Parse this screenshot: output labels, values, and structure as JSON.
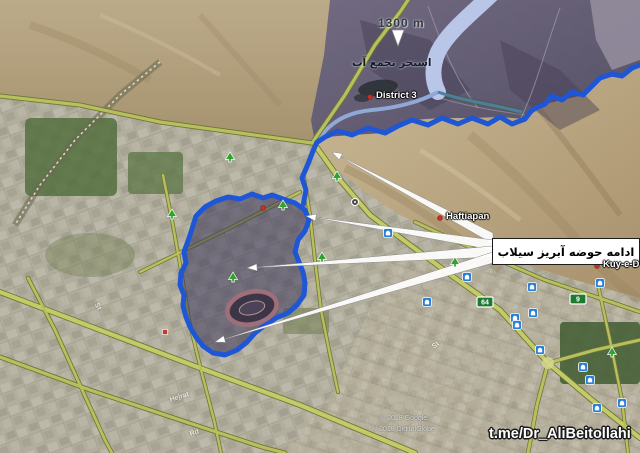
{
  "map": {
    "flood_basin_label": "ادامه حوضه آبریز سیلاب",
    "elevation_label": "1300 m",
    "water_pool_label": "استخر تجمع آب",
    "watermark": "t.me/Dr_AliBeitollahi",
    "copyright_lines": [
      "© 2018 Google",
      "© 2018 DigitalGlobe"
    ],
    "places": [
      {
        "name": "District 3",
        "x": 370,
        "y": 97
      },
      {
        "name": "Haftiapan",
        "x": 440,
        "y": 218
      },
      {
        "name": "Kuy-e-D",
        "x": 597,
        "y": 266
      }
    ],
    "street_labels": [
      {
        "text": "Hejrat",
        "x": 170,
        "y": 397,
        "rot": -18
      },
      {
        "text": "Rd",
        "x": 190,
        "y": 431,
        "rot": -18
      },
      {
        "text": "St",
        "x": 96,
        "y": 300,
        "rot": 62
      },
      {
        "text": "St",
        "x": 433,
        "y": 344,
        "rot": -35
      }
    ],
    "route_shields": [
      {
        "number": "64",
        "x": 485,
        "y": 302
      },
      {
        "number": "9",
        "x": 578,
        "y": 299
      }
    ],
    "tree_icons": [
      [
        230,
        158
      ],
      [
        337,
        177
      ],
      [
        283,
        206
      ],
      [
        172,
        215
      ],
      [
        233,
        278
      ],
      [
        322,
        258
      ],
      [
        455,
        263
      ],
      [
        612,
        353
      ]
    ],
    "mosque_icons": [
      [
        388,
        233
      ],
      [
        467,
        277
      ],
      [
        515,
        318
      ],
      [
        533,
        313
      ],
      [
        517,
        325
      ],
      [
        540,
        350
      ],
      [
        583,
        367
      ],
      [
        590,
        380
      ],
      [
        600,
        283
      ],
      [
        532,
        287
      ],
      [
        622,
        403
      ],
      [
        597,
        408
      ],
      [
        427,
        302
      ]
    ],
    "red_dot_icons": [
      [
        263,
        208
      ]
    ],
    "misc_icons": [
      {
        "type": "roundabout",
        "x": 355,
        "y": 202
      },
      {
        "type": "building",
        "x": 165,
        "y": 332
      }
    ],
    "arrows": [
      {
        "apex": [
          332,
          152
        ],
        "base": [
          [
            493,
            233
          ],
          [
            493,
            244
          ]
        ]
      },
      {
        "apex": [
          306,
          216
        ],
        "base": [
          [
            493,
            240
          ],
          [
            493,
            250
          ]
        ]
      },
      {
        "apex": [
          247,
          268
        ],
        "base": [
          [
            493,
            246
          ],
          [
            493,
            257
          ]
        ]
      },
      {
        "apex": [
          215,
          342
        ],
        "base": [
          [
            493,
            252
          ],
          [
            493,
            263
          ]
        ]
      }
    ],
    "down_arrow": {
      "x": 398,
      "y": 38
    },
    "colors": {
      "watershed_outline": "#1e56d6",
      "basin_fill": "rgba(52,48,86,0.52)",
      "arrow_fill": "#ffffff",
      "label_box_bg": "#ffffff",
      "road": "#b8bf5f",
      "river": "#b9c6e8"
    }
  }
}
